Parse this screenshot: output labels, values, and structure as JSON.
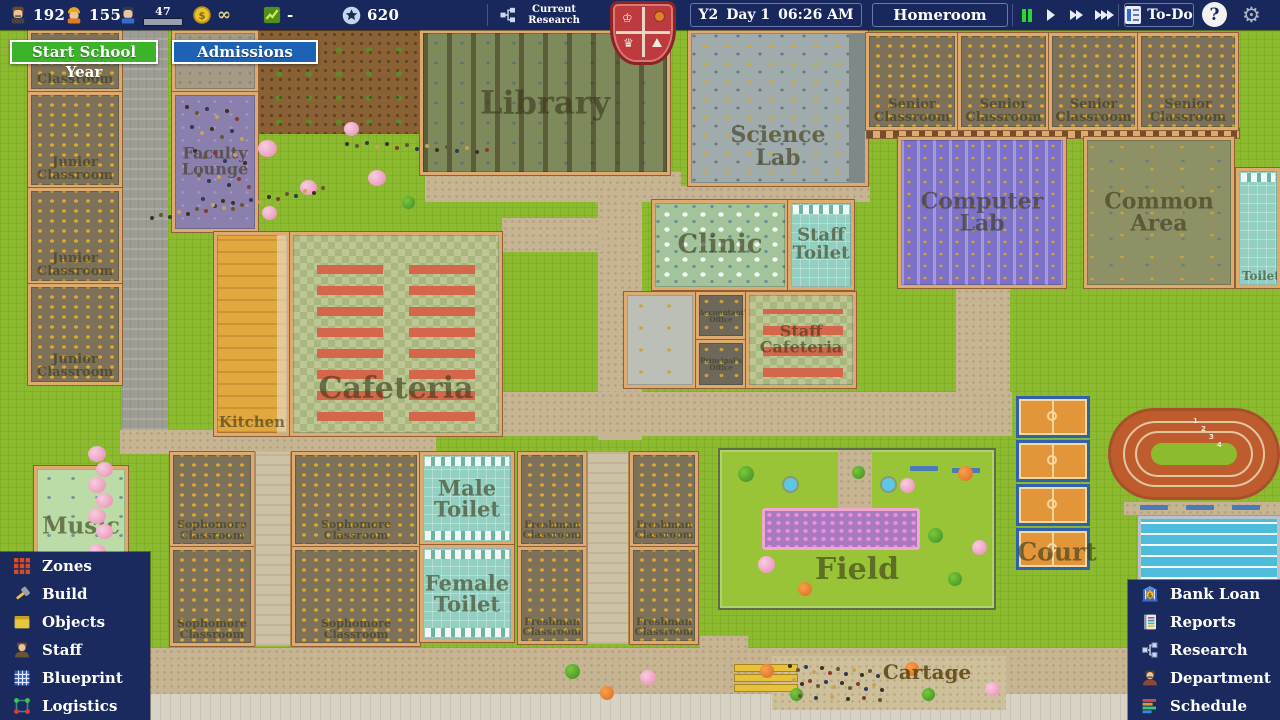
{
  "top_bar": {
    "resources": [
      {
        "icon": "teacher-icon",
        "value": "192"
      },
      {
        "icon": "builder-icon",
        "value": "155"
      },
      {
        "icon": "student-icon",
        "value": "47"
      },
      {
        "icon": "coin-icon",
        "value": "∞"
      },
      {
        "icon": "growth-icon",
        "value": "-"
      },
      {
        "icon": "reputation-star-icon",
        "value": "620"
      }
    ],
    "research": {
      "icon": "org-chart-icon",
      "label": "Current Research"
    },
    "clock": {
      "year": "Y2",
      "day": "Day 1",
      "time": "06:26 AM"
    },
    "homeroom_label": "Homeroom",
    "todo_label": "To-Do",
    "help_label": "?"
  },
  "action_buttons": {
    "start_school_year": "Start School Year",
    "admissions": "Admissions"
  },
  "left_menu": {
    "items": [
      {
        "icon": "zones-icon",
        "label": "Zones"
      },
      {
        "icon": "build-icon",
        "label": "Build"
      },
      {
        "icon": "objects-icon",
        "label": "Objects"
      },
      {
        "icon": "staff-icon",
        "label": "Staff"
      },
      {
        "icon": "blueprint-icon",
        "label": "Blueprint"
      },
      {
        "icon": "logistics-icon",
        "label": "Logistics"
      }
    ]
  },
  "right_menu": {
    "items": [
      {
        "icon": "bank-loan-icon",
        "label": "Bank Loan"
      },
      {
        "icon": "reports-icon",
        "label": "Reports"
      },
      {
        "icon": "research-icon",
        "label": "Research"
      },
      {
        "icon": "department-icon",
        "label": "Department"
      },
      {
        "icon": "schedule-icon",
        "label": "Schedule"
      }
    ]
  },
  "map": {
    "rooms": [
      {
        "name": "junior-classroom-1",
        "label": "Classroom"
      },
      {
        "name": "junior-classroom-2",
        "label": "Junior\nClassroom"
      },
      {
        "name": "junior-classroom-3",
        "label": "Junior\nClassroom"
      },
      {
        "name": "junior-classroom-4",
        "label": "Junior\nClassroom"
      },
      {
        "name": "faculty-lounge",
        "label": "Faculty\nLounge"
      },
      {
        "name": "kitchen",
        "label": "Kitchen"
      },
      {
        "name": "cafeteria",
        "label": "Cafeteria"
      },
      {
        "name": "library",
        "label": "Library"
      },
      {
        "name": "science-lab",
        "label": "Science\nLab"
      },
      {
        "name": "clinic",
        "label": "Clinic"
      },
      {
        "name": "staff-toilet",
        "label": "Staff\nToilet"
      },
      {
        "name": "accountants-office",
        "label": "Accountant's\nOffice"
      },
      {
        "name": "principals-office",
        "label": "Principal's\nOffice"
      },
      {
        "name": "staff-cafeteria",
        "label": "Staff\nCafeteria"
      },
      {
        "name": "senior-classroom-1",
        "label": "Senior\nClassroom"
      },
      {
        "name": "senior-classroom-2",
        "label": "Senior\nClassroom"
      },
      {
        "name": "senior-classroom-3",
        "label": "Senior\nClassroom"
      },
      {
        "name": "senior-classroom-4",
        "label": "Senior\nClassroom"
      },
      {
        "name": "computer-lab",
        "label": "Computer\nLab"
      },
      {
        "name": "common-area",
        "label": "Common\nArea"
      },
      {
        "name": "toilet-east",
        "label": "Toilet"
      },
      {
        "name": "music-room",
        "label": "Music"
      },
      {
        "name": "sophomore-classroom-1",
        "label": "Sophomore\nClassroom"
      },
      {
        "name": "sophomore-classroom-2",
        "label": "Sophomore\nClassroom"
      },
      {
        "name": "sophomore-classroom-3",
        "label": "Sophomore\nClassroom"
      },
      {
        "name": "sophomore-classroom-4",
        "label": "Sophomore\nClassroom"
      },
      {
        "name": "male-toilet",
        "label": "Male\nToilet"
      },
      {
        "name": "female-toilet",
        "label": "Female\nToilet"
      },
      {
        "name": "freshman-classroom-1",
        "label": "Freshman\nClassroom"
      },
      {
        "name": "freshman-classroom-2",
        "label": "Freshman\nClassroom"
      },
      {
        "name": "freshman-classroom-3",
        "label": "Freshman\nClassroom"
      },
      {
        "name": "freshman-classroom-4",
        "label": "Freshman\nClassroom"
      },
      {
        "name": "field",
        "label": "Field"
      },
      {
        "name": "court",
        "label": "Court"
      },
      {
        "name": "cartage",
        "label": "Cartage"
      }
    ],
    "track_lane_numbers": [
      "1",
      "2",
      "3",
      "4"
    ]
  },
  "colors": {
    "topbar_bg": "#18275c",
    "menu_bg": "#1a2a5e",
    "start_button_green": "#3cb32b",
    "admissions_button_blue": "#1d62b5",
    "pause_active_green": "#29d829",
    "grass": "#8cbb2f",
    "crest_red": "#bd3a3e"
  }
}
